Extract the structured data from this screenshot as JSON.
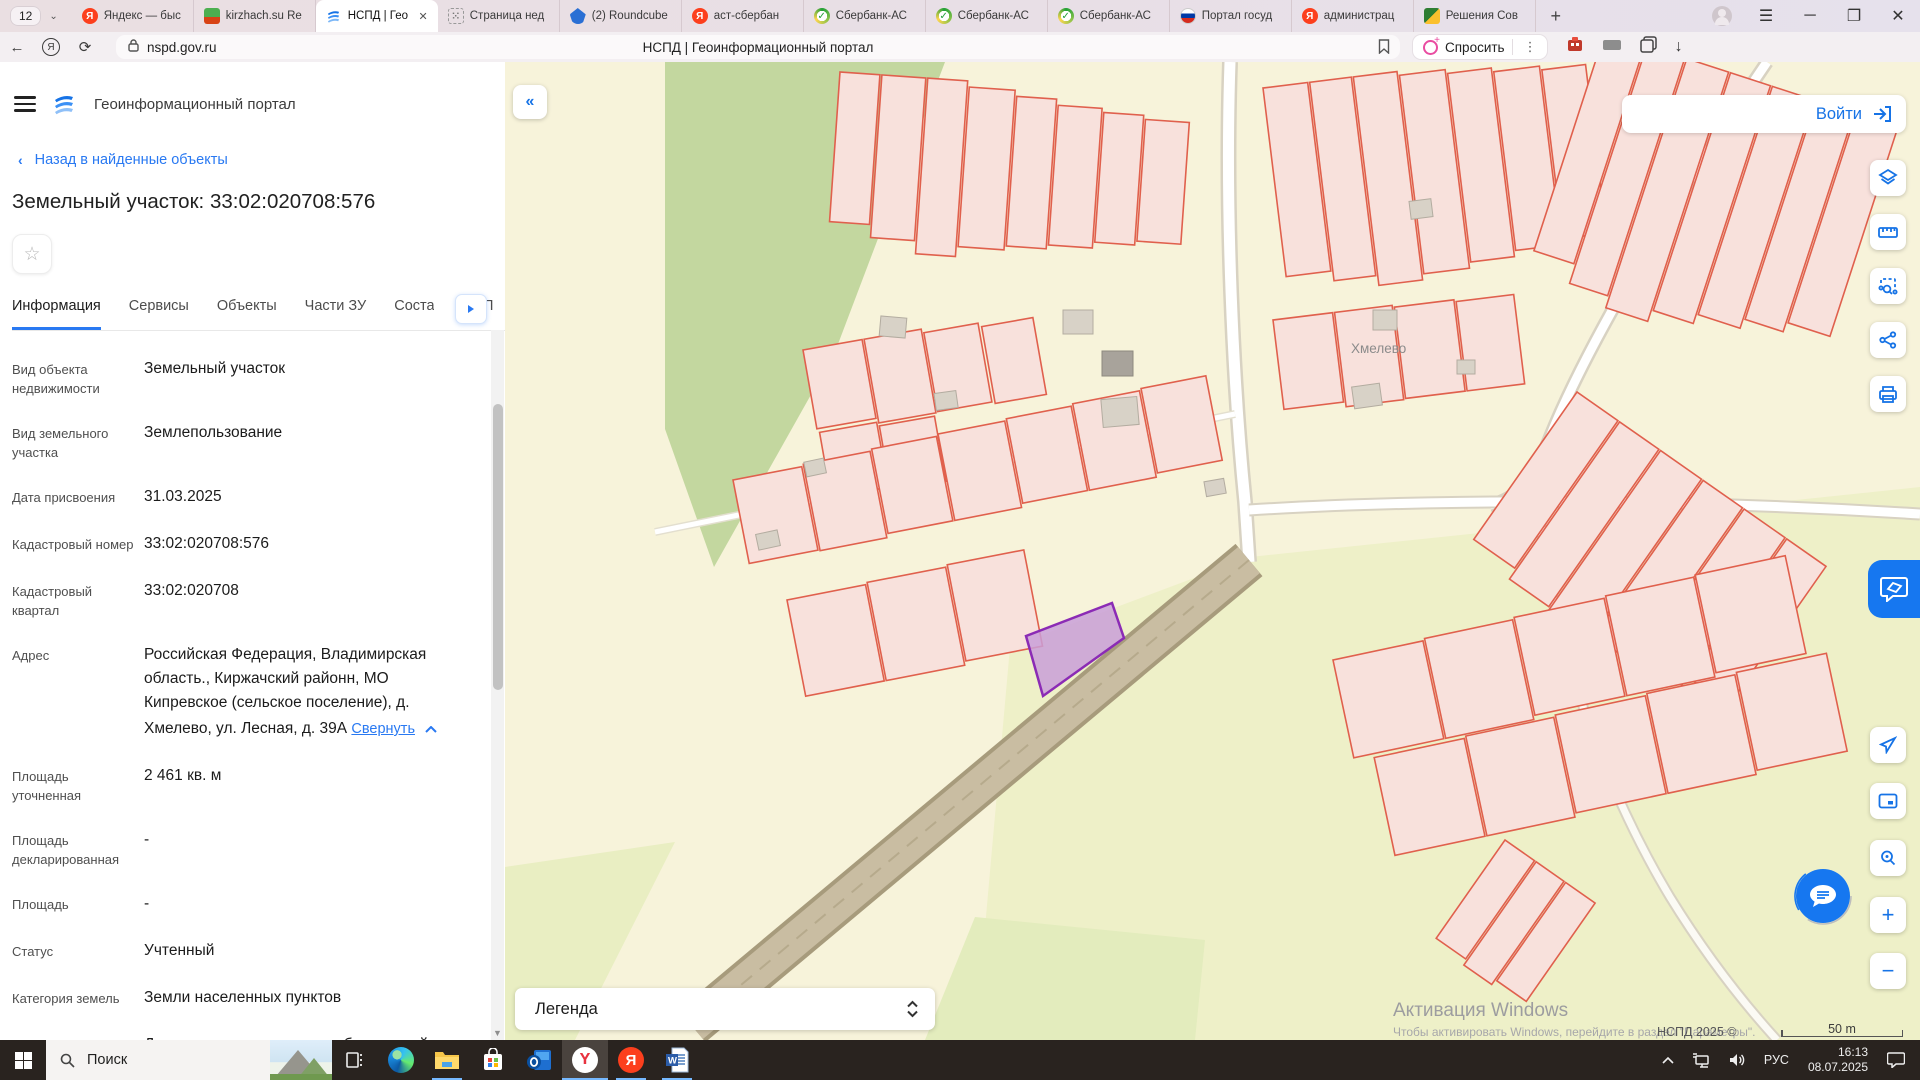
{
  "browser": {
    "tab_count": "12",
    "tabs": [
      {
        "title": "Яндекс — быс"
      },
      {
        "title": "kirzhach.su Re"
      },
      {
        "title": "НСПД | Гео"
      },
      {
        "title": "Страница нед"
      },
      {
        "title": "(2) Roundcube"
      },
      {
        "title": "аст-сбербан"
      },
      {
        "title": "Сбербанк-АС"
      },
      {
        "title": "Сбербанк-АС"
      },
      {
        "title": "Сбербанк-АС"
      },
      {
        "title": "Портал госуд"
      },
      {
        "title": "администрац"
      },
      {
        "title": "Решения Сов"
      }
    ],
    "address": {
      "url": "nspd.gov.ru",
      "page_title": "НСПД | Геоинформационный портал",
      "ask_label": "Спросить"
    }
  },
  "panel": {
    "app_title": "Геоинформационный портал",
    "back_link": "Назад в найденные объекты",
    "title": "Земельный участок: 33:02:020708:576",
    "tabs": [
      {
        "label": "Информация"
      },
      {
        "label": "Сервисы"
      },
      {
        "label": "Объекты"
      },
      {
        "label": "Части ЗУ"
      },
      {
        "label": "Соста"
      },
      {
        "label": "П"
      }
    ],
    "fields_top": [
      {
        "label": "Вид объекта недвижимости",
        "value": "Земельный участок"
      },
      {
        "label": "Вид земельного участка",
        "value": "Землепользование"
      },
      {
        "label": "Дата присвоения",
        "value": "31.03.2025"
      },
      {
        "label": "Кадастровый номер",
        "value": "33:02:020708:576"
      },
      {
        "label": "Кадастровый квартал",
        "value": "33:02:020708"
      }
    ],
    "address_field": {
      "label": "Адрес",
      "value": "Российская Федерация, Владимирская область., Киржачский районн, МО Кипревское (сельское поселение), д. Хмелево, ул. Лесная, д. 39А",
      "collapse_label": "Свернуть"
    },
    "fields_bottom": [
      {
        "label": "Площадь уточненная",
        "value": "2 461 кв. м"
      },
      {
        "label": "Площадь декларированная",
        "value": "-"
      },
      {
        "label": "Площадь",
        "value": "-"
      },
      {
        "label": "Статус",
        "value": "Учтенный"
      },
      {
        "label": "Категория земель",
        "value": "Земли населенных пунктов"
      },
      {
        "label": "Вид разрешенного использования",
        "value": "Для ведения личного подсобного хозяйства (приусадебный земельный участок)"
      }
    ]
  },
  "map": {
    "login_label": "Войти",
    "legend_label": "Легенда",
    "settlement_label": "Хмелево",
    "copyright": "НСПД 2025 ©",
    "scale_label": "50 m",
    "watermark_title": "Активация Windows",
    "watermark_subtitle": "Чтобы активировать Windows, перейдите в раздел \"Параметры\".",
    "selected_parcel": "33:02:020708:576",
    "colors": {
      "parcel_fill": "#f8e1dc",
      "parcel_outline": "#e0604d",
      "selected_fill": "#c99fd8",
      "selected_outline": "#8b2bb5"
    }
  },
  "taskbar": {
    "search_placeholder": "Поиск",
    "language": "РУС",
    "time": "16:13",
    "date": "08.07.2025"
  }
}
